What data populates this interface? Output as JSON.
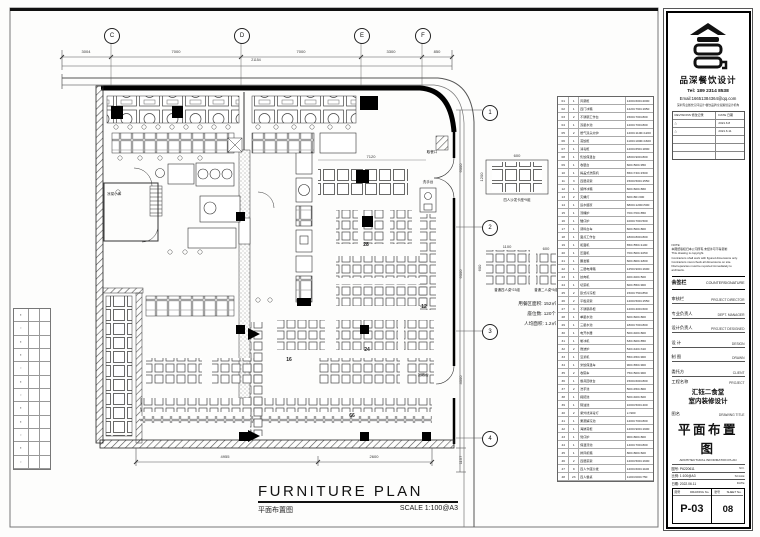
{
  "sheet": {
    "paper": "#fdfdfc",
    "background": "#e3e3df",
    "line_color": "#1a1a1a"
  },
  "title_bar": {
    "main": "FURNITURE PLAN",
    "cn": "平面布置图",
    "scale": "SCALE 1:100@A3"
  },
  "grid": {
    "top": [
      "C",
      "D",
      "E",
      "F"
    ],
    "side": [
      "1",
      "2",
      "3",
      "4"
    ]
  },
  "dims": {
    "top": [
      "3004",
      "7000",
      "7000",
      "3300",
      "850"
    ],
    "top_total": "21154",
    "bottom": [
      "4955",
      "2600"
    ],
    "right": [
      "6000",
      "6000",
      "4000",
      "1157"
    ],
    "interior": "7120",
    "mini": {
      "a": "600",
      "b": "1200",
      "c": "1100",
      "d": "600",
      "e": "600"
    }
  },
  "plan": {
    "seats": {
      "s28": "28",
      "s12": "12",
      "s24": "24",
      "s16": "16",
      "s66": "66"
    },
    "rooms": {
      "cold": "凉菜小库",
      "wash": "洗手台",
      "pickup": "取餐口",
      "return": "回收台"
    }
  },
  "annot": {
    "booth_caption": "四人沙发卡座*9组",
    "t4_caption": "普通四人桌*23组",
    "t2_caption": "普通二人桌*5组",
    "stats": [
      "用餐区面积: 152㎡",
      "座位数: 120个",
      "人均面积: 1.2㎡"
    ]
  },
  "legend": {
    "rows": [
      {
        "no": "01",
        "qty": "1",
        "name": "风幕柜",
        "size": "1200×600×2000"
      },
      {
        "no": "02",
        "qty": "1",
        "name": "四门冰箱",
        "size": "1220×760×1950"
      },
      {
        "no": "03",
        "qty": "2",
        "name": "不锈钢工作台",
        "size": "1500×700×800"
      },
      {
        "no": "04",
        "qty": "1",
        "name": "双星水池",
        "size": "1200×700×800"
      },
      {
        "no": "05",
        "qty": "2",
        "name": "燃气双头炒炉",
        "size": "1200×1100×1200"
      },
      {
        "no": "06",
        "qty": "1",
        "name": "蒸饭柜",
        "size": "1100×1000×1600"
      },
      {
        "no": "07",
        "qty": "1",
        "name": "消毒柜",
        "size": "1200×650×1800"
      },
      {
        "no": "08",
        "qty": "1",
        "name": "售饭保温台",
        "size": "1800×900×800"
      },
      {
        "no": "09",
        "qty": "1",
        "name": "收银台",
        "size": "600×500×950"
      },
      {
        "no": "10",
        "qty": "1",
        "name": "揭盖式洗碗机",
        "size": "650×740×1500"
      },
      {
        "no": "11",
        "qty": "3",
        "name": "四层货架",
        "size": "1500×500×1550"
      },
      {
        "no": "12",
        "qty": "1",
        "name": "留样冰箱",
        "size": "600×600×860"
      },
      {
        "no": "13",
        "qty": "2",
        "name": "灭蝇灯",
        "size": "600×80×300"
      },
      {
        "no": "14",
        "qty": "1",
        "name": "运水烟罩",
        "size": "6800×1200×500"
      },
      {
        "no": "15",
        "qty": "1",
        "name": "汤桶炉",
        "size": "700×700×850"
      },
      {
        "no": "16",
        "qty": "1",
        "name": "矮仔炉",
        "size": "1000×700×500"
      },
      {
        "no": "17",
        "qty": "1",
        "name": "调料台车",
        "size": "600×500×800"
      },
      {
        "no": "18",
        "qty": "1",
        "name": "面点工作台",
        "size": "1800×800×800"
      },
      {
        "no": "19",
        "qty": "1",
        "name": "和面机",
        "size": "650×550×1100"
      },
      {
        "no": "20",
        "qty": "1",
        "name": "压面机",
        "size": "700×500×1050"
      },
      {
        "no": "21",
        "qty": "1",
        "name": "醒发箱",
        "size": "600×800×1800"
      },
      {
        "no": "22",
        "qty": "1",
        "name": "三层电烤箱",
        "size": "1250×900×1600"
      },
      {
        "no": "23",
        "qty": "1",
        "name": "绞肉机",
        "size": "400×400×500"
      },
      {
        "no": "24",
        "qty": "1",
        "name": "切菜机",
        "size": "600×550×900"
      },
      {
        "no": "25",
        "qty": "2",
        "name": "卧式冷冻柜",
        "size": "1500×750×850"
      },
      {
        "no": "26",
        "qty": "2",
        "name": "平板货架",
        "size": "1200×500×1550"
      },
      {
        "no": "27",
        "qty": "4",
        "name": "不锈钢吊柜",
        "size": "1200×400×600"
      },
      {
        "no": "28",
        "qty": "1",
        "name": "单星水池",
        "size": "600×600×800"
      },
      {
        "no": "29",
        "qty": "1",
        "name": "三星水池",
        "size": "1800×700×800"
      },
      {
        "no": "30",
        "qty": "1",
        "name": "电开水器",
        "size": "500×400×800"
      },
      {
        "no": "31",
        "qty": "1",
        "name": "制冰机",
        "size": "630×600×850"
      },
      {
        "no": "32",
        "qty": "2",
        "name": "微波炉",
        "size": "520×420×310"
      },
      {
        "no": "33",
        "qty": "1",
        "name": "豆浆机",
        "size": "550×450×900"
      },
      {
        "no": "34",
        "qty": "1",
        "name": "米饭保温车",
        "size": "900×650×900"
      },
      {
        "no": "35",
        "qty": "2",
        "name": "收碗车",
        "size": "750×500×900"
      },
      {
        "no": "36",
        "qty": "1",
        "name": "餐具回收台",
        "size": "1500×600×800"
      },
      {
        "no": "37",
        "qty": "2",
        "name": "洗手池",
        "size": "500×450×800"
      },
      {
        "no": "38",
        "qty": "1",
        "name": "拖把池",
        "size": "500×400×600"
      },
      {
        "no": "39",
        "qty": "1",
        "name": "隔油池",
        "size": "1000×500×400"
      },
      {
        "no": "40",
        "qty": "2",
        "name": "紫外线消毒灯",
        "size": "L=900"
      },
      {
        "no": "41",
        "qty": "1",
        "name": "果蔬解冻池",
        "size": "1200×700×800"
      },
      {
        "no": "42",
        "qty": "1",
        "name": "海鲜蒸柜",
        "size": "1200×900×1900"
      },
      {
        "no": "43",
        "qty": "1",
        "name": "煲仔炉",
        "size": "900×800×800"
      },
      {
        "no": "44",
        "qty": "1",
        "name": "保温汤池",
        "size": "1400×700×800"
      },
      {
        "no": "45",
        "qty": "1",
        "name": "排风机箱",
        "size": "800×800×600"
      },
      {
        "no": "46",
        "qty": "2",
        "name": "四层菜架",
        "size": "1200×500×1600"
      },
      {
        "no": "47",
        "qty": "9",
        "name": "四人卡座沙发",
        "size": "1200×600×1100"
      },
      {
        "no": "48",
        "qty": "23",
        "name": "四人餐桌",
        "size": "1100×600×750"
      }
    ]
  },
  "side_table": {
    "rows": [
      {
        "m": "▪"
      },
      {
        "m": "▫"
      },
      {
        "m": "▪"
      },
      {
        "m": "▪"
      },
      {
        "m": "▫"
      },
      {
        "m": "▪"
      },
      {
        "m": "▫"
      },
      {
        "m": "▪"
      },
      {
        "m": "▪"
      },
      {
        "m": "▫"
      },
      {
        "m": "▪"
      },
      {
        "m": "▫"
      }
    ]
  },
  "tb": {
    "brand": {
      "name": "品深餐饮设计",
      "tel": "Tel: 189 2314 8538",
      "email": "Email:16651384364@qq.com",
      "tagline": "深圳专业餐饮空间设计/餐饮品牌全案策划设计机构"
    },
    "rev": {
      "h1": "REVISIONS 修改记录",
      "h2": "DATE 日期",
      "rows": [
        {
          "r": "△",
          "d": "2021.6.8"
        },
        {
          "r": "△",
          "d": "2021.6.11"
        },
        {
          "r": "",
          "d": ""
        },
        {
          "r": "",
          "d": ""
        },
        {
          "r": "",
          "d": ""
        }
      ]
    },
    "notes": [
      "NOTE:",
      "本图纸版权归本公司所有,未经许可不得复制",
      "This drawing is copyright.",
      "Contractors shall work with figured dimensions only.",
      "Contractors must check all dimensions on site.",
      "Discrepancies must be reported immediately to architects."
    ],
    "countersign": {
      "cn": "会签栏",
      "en": "COUNTERSIGNATURE"
    },
    "signoff": [
      {
        "cn": "审核栏",
        "en": "PROJECT DIRECTOR"
      },
      {
        "cn": "专业负责人",
        "en": "DEPT. MANAGER"
      },
      {
        "cn": "设计负责人",
        "en": "PROJECT DESIGNED"
      },
      {
        "cn": "设 计",
        "en": "DESIGN"
      },
      {
        "cn": "制 图",
        "en": "DRAWN"
      },
      {
        "cn": "委托方",
        "en": "CLIENT"
      }
    ],
    "project": {
      "cn": "工程名称",
      "en": "PROJECT",
      "line1": "汇钰二食堂",
      "line2": "室内装修设计"
    },
    "drawing": {
      "cn": "图名",
      "en": "DRAWING TITLE",
      "title": "平面布置图",
      "en_title": "ARCHITECTURAL INFORMATION PLAN"
    },
    "meta": [
      {
        "l": "图号: P6220611",
        "r": "NO."
      },
      {
        "l": "比例: 1:100@A3",
        "r": "SCALE"
      },
      {
        "l": "日期: 2022.06.11",
        "r": "DATE"
      }
    ],
    "numbers": {
      "dwg_cn": "图号",
      "dwg_en": "DRAWING No.",
      "dwg": "P-03",
      "sheet_cn": "张号",
      "sheet_en": "SHEET No.",
      "sheet": "08"
    }
  }
}
